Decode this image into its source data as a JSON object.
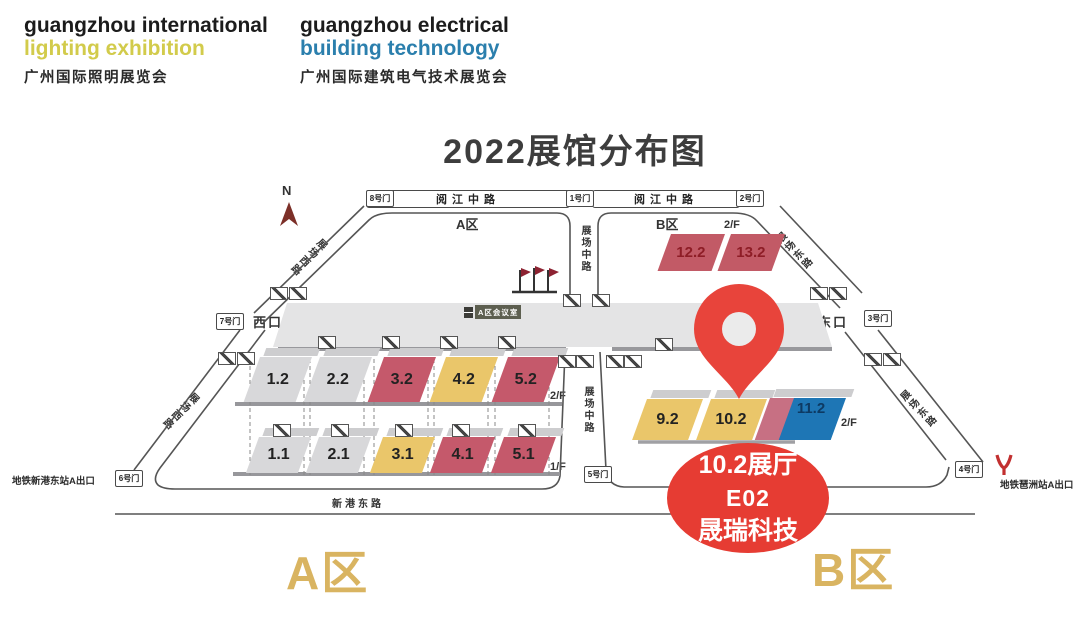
{
  "header": {
    "logo1": {
      "line1": "guangzhou international",
      "line2": "lighting exhibition",
      "line3": "广州国际照明展览会",
      "accent_color": "#d2cb4b"
    },
    "logo2": {
      "line1": "guangzhou electrical",
      "line2": "building technology",
      "line3": "广州国际建筑电气技术展览会",
      "accent_color": "#2b7fad"
    }
  },
  "title": "2022展馆分布图",
  "map": {
    "north": "N",
    "area_labels": {
      "a_top": "A区",
      "b_top": "B区",
      "a_bottom": "A区",
      "b_bottom": "B区"
    },
    "floor_labels": {
      "f2": "2/F",
      "f1": "1/F"
    },
    "roads": {
      "yuejiang": "阅江中路",
      "zhujiang_promenade": "珠江散步道",
      "zhujiang_short": "珠江散",
      "zhongpingtai": "中平台",
      "xingang_east": "新港东路",
      "zhanchang_middle": "展场中路",
      "zhanchang_west": "展场西路",
      "zhanchang_east": "展场东路"
    },
    "gates": {
      "g1": "1号门",
      "g2": "2号门",
      "g3": "3号门",
      "g4": "4号门",
      "g5": "5号门",
      "g6": "6号门",
      "g7": "7号门",
      "g8": "8号门"
    },
    "entrances": {
      "west": "西口",
      "east": "东口"
    },
    "metro": {
      "left": "地铁新港东站A出口",
      "right": "地铁琶洲站A出口"
    },
    "meeting_room": "A区会议室",
    "halls": {
      "a_upper": [
        {
          "id": "1.2",
          "fill": "#d8d8da",
          "text": "#222222"
        },
        {
          "id": "2.2",
          "fill": "#d8d8da",
          "text": "#222222"
        },
        {
          "id": "3.2",
          "fill": "#c5596b",
          "text": "#1f1f1f"
        },
        {
          "id": "4.2",
          "fill": "#eac66a",
          "text": "#1f1f1f"
        },
        {
          "id": "5.2",
          "fill": "#c5596b",
          "text": "#1f1f1f"
        }
      ],
      "a_lower": [
        {
          "id": "1.1",
          "fill": "#d8d8da",
          "text": "#222222"
        },
        {
          "id": "2.1",
          "fill": "#d8d8da",
          "text": "#222222"
        },
        {
          "id": "3.1",
          "fill": "#eac66a",
          "text": "#1f1f1f"
        },
        {
          "id": "4.1",
          "fill": "#c5596b",
          "text": "#1f1f1f"
        },
        {
          "id": "5.1",
          "fill": "#c5596b",
          "text": "#1f1f1f"
        }
      ],
      "b_upper": [
        {
          "id": "12.2",
          "fill": "#c25a66",
          "text": "#8e1d26"
        },
        {
          "id": "13.2",
          "fill": "#c25a66",
          "text": "#8e1d26"
        }
      ],
      "b_lower": [
        {
          "id": "9.2",
          "fill": "#eac66a",
          "text": "#1f1f1f"
        },
        {
          "id": "10.2",
          "fill": "#eac66a",
          "text": "#1f1f1f"
        },
        {
          "id": "11.2",
          "fill_left": "#c77083",
          "fill_right": "#1e76b5",
          "text": "#0d3a63"
        }
      ]
    },
    "pin_color": "#e8443b"
  },
  "location_badge": {
    "line1": "10.2展厅",
    "line2": "E02",
    "line3": "晟瑞科技",
    "color": "#e63c33"
  }
}
